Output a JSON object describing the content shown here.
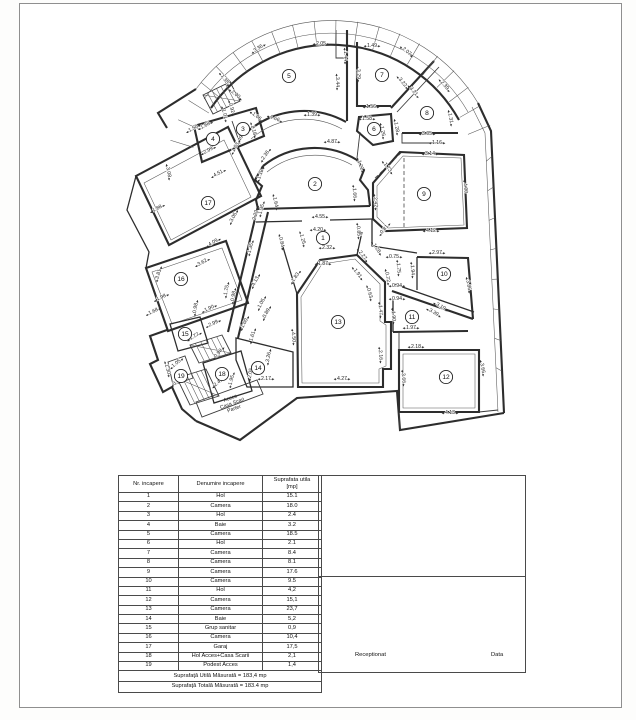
{
  "plan": {
    "rooms": [
      [
        "1",
        323,
        238
      ],
      [
        "2",
        315,
        184
      ],
      [
        "3",
        243,
        129
      ],
      [
        "4",
        213,
        139
      ],
      [
        "5",
        289,
        76
      ],
      [
        "6",
        374,
        129
      ],
      [
        "7",
        382,
        75
      ],
      [
        "8",
        427,
        113
      ],
      [
        "9",
        424,
        194
      ],
      [
        "10",
        444,
        274
      ],
      [
        "11",
        412,
        317
      ],
      [
        "12",
        446,
        377
      ],
      [
        "13",
        338,
        322
      ],
      [
        "14",
        258,
        368
      ],
      [
        "15",
        185,
        334
      ],
      [
        "16",
        181,
        279
      ],
      [
        "17",
        208,
        203
      ],
      [
        "18",
        222,
        374
      ],
      [
        "19",
        181,
        376
      ]
    ],
    "dims": [
      [
        "3.36",
        258,
        48,
        -33
      ],
      [
        "2.05",
        321,
        43,
        0
      ],
      [
        "1.49",
        372,
        45,
        0
      ],
      [
        "2.07",
        407,
        51,
        40
      ],
      [
        "1.44",
        346,
        56,
        88
      ],
      [
        "3.44",
        338,
        82,
        88
      ],
      [
        "3.29",
        359,
        74,
        88
      ],
      [
        "1.35",
        225,
        79,
        55
      ],
      [
        "2.00",
        236,
        94,
        40
      ],
      [
        "1.39",
        312,
        114,
        0
      ],
      [
        "1.66",
        275,
        118,
        22
      ],
      [
        "1.06",
        257,
        116,
        38
      ],
      [
        "0.92",
        232,
        108,
        75
      ],
      [
        "1.01",
        225,
        114,
        75
      ],
      [
        "3.22",
        403,
        82,
        50
      ],
      [
        "3.21",
        414,
        91,
        50
      ],
      [
        "2.39",
        445,
        85,
        50
      ],
      [
        "1.31",
        451,
        118,
        80
      ],
      [
        "1.56",
        371,
        106,
        0
      ],
      [
        "1.58",
        367,
        118,
        0
      ],
      [
        "1.26",
        383,
        131,
        80
      ],
      [
        "1.28",
        397,
        127,
        80
      ],
      [
        "3.05",
        427,
        133,
        0
      ],
      [
        "1.16",
        437,
        142,
        0
      ],
      [
        "4.87",
        332,
        141,
        0
      ],
      [
        "2.36",
        265,
        155,
        -55
      ],
      [
        "1.18",
        260,
        174,
        -70
      ],
      [
        "1.18",
        254,
        130,
        75
      ],
      [
        "1.21",
        361,
        165,
        70
      ],
      [
        "1.64",
        276,
        202,
        78
      ],
      [
        "1.66",
        355,
        193,
        85
      ],
      [
        "4.55",
        320,
        216,
        0
      ],
      [
        "4.20",
        318,
        229,
        0
      ],
      [
        "1.25",
        303,
        239,
        75
      ],
      [
        "0.84",
        282,
        242,
        78
      ],
      [
        "0.85",
        359,
        231,
        85
      ],
      [
        "2.32",
        327,
        247,
        0
      ],
      [
        "1.28",
        377,
        248,
        55
      ],
      [
        "1.73",
        388,
        167,
        52
      ],
      [
        "3.14",
        430,
        153,
        0
      ],
      [
        "4.00",
        466,
        188,
        85
      ],
      [
        "2.42",
        376,
        202,
        85
      ],
      [
        "4.12",
        431,
        230,
        0
      ],
      [
        "0.81",
        384,
        229,
        -50
      ],
      [
        "1.50",
        193,
        128,
        -28
      ],
      [
        "1.68",
        205,
        125,
        -28
      ],
      [
        "1.49",
        239,
        140,
        -60
      ],
      [
        "1.63",
        235,
        147,
        -60
      ],
      [
        "2.99",
        208,
        150,
        -28
      ],
      [
        "4.51",
        218,
        173,
        -28
      ],
      [
        "3.08",
        169,
        172,
        80
      ],
      [
        "1.88",
        157,
        208,
        -28
      ],
      [
        "3.05",
        233,
        217,
        -62
      ],
      [
        "2.22",
        255,
        215,
        -75
      ],
      [
        "1.35",
        261,
        209,
        -75
      ],
      [
        "4.09",
        213,
        242,
        -30
      ],
      [
        "1.35",
        250,
        248,
        -75
      ],
      [
        "3.62",
        202,
        262,
        -28
      ],
      [
        "3.81",
        158,
        274,
        -73
      ],
      [
        "1.75",
        226,
        290,
        -80
      ],
      [
        "0.98",
        233,
        296,
        -80
      ],
      [
        "1.98",
        161,
        297,
        -25
      ],
      [
        "1.68",
        153,
        311,
        -25
      ],
      [
        "1.90",
        209,
        308,
        -25
      ],
      [
        "0.98",
        195,
        308,
        -80
      ],
      [
        "2.99",
        213,
        323,
        -25
      ],
      [
        "4.13",
        255,
        281,
        -62
      ],
      [
        "1.05",
        261,
        303,
        -62
      ],
      [
        "0.89",
        266,
        313,
        -62
      ],
      [
        "1.60",
        244,
        323,
        -62
      ],
      [
        "1.61",
        252,
        336,
        -72
      ],
      [
        "1.77",
        194,
        336,
        -30
      ],
      [
        "0.98",
        218,
        353,
        -50
      ],
      [
        "3.26",
        268,
        357,
        -80
      ],
      [
        "2.05",
        250,
        373,
        -80
      ],
      [
        "2.17",
        266,
        378,
        0
      ],
      [
        "2.41",
        218,
        382,
        -40
      ],
      [
        "1.95",
        231,
        380,
        -75
      ],
      [
        "1.05",
        176,
        363,
        -40
      ],
      [
        "0.80",
        177,
        381,
        -40
      ],
      [
        "1.30",
        168,
        369,
        75
      ],
      [
        "1.87",
        323,
        263,
        0
      ],
      [
        "2.27",
        363,
        255,
        52
      ],
      [
        "1.91",
        358,
        273,
        52
      ],
      [
        "1.83",
        295,
        277,
        -55
      ],
      [
        "4.50",
        294,
        337,
        85
      ],
      [
        "4.27",
        342,
        378,
        0
      ],
      [
        "0.63",
        370,
        293,
        75
      ],
      [
        "1.47",
        381,
        310,
        85
      ],
      [
        "2.16",
        381,
        355,
        85
      ],
      [
        "0.75",
        394,
        256,
        0
      ],
      [
        "1.75",
        399,
        268,
        85
      ],
      [
        "0.72",
        388,
        277,
        80
      ],
      [
        "0.94",
        397,
        285,
        0
      ],
      [
        "1.94",
        413,
        270,
        85
      ],
      [
        "2.97",
        437,
        252,
        0
      ],
      [
        "3.86",
        469,
        285,
        80
      ],
      [
        "0.94",
        397,
        298,
        0
      ],
      [
        "1.90",
        394,
        316,
        85
      ],
      [
        "3.19",
        441,
        306,
        30
      ],
      [
        "3.39",
        434,
        312,
        30
      ],
      [
        "1.97",
        411,
        327,
        0
      ],
      [
        "2.18",
        416,
        346,
        0
      ],
      [
        "3.66",
        404,
        378,
        85
      ],
      [
        "3.66",
        483,
        368,
        80
      ],
      [
        "4.13",
        450,
        412,
        0
      ]
    ],
    "access_label": {
      "lines": [
        "Acces",
        "Casa Scari",
        "Parter"
      ],
      "x": 228,
      "y": 392,
      "r": -20
    }
  },
  "table": {
    "header_col1": "Nr. incapere",
    "header_col2": "Denumire incapere",
    "header_col3_line1": "Suprafata utila",
    "header_col3_line2": "[mp]",
    "rows": [
      [
        "1",
        "Hol",
        "15.1"
      ],
      [
        "2",
        "Camera",
        "18.0"
      ],
      [
        "3",
        "Hol",
        "2.4"
      ],
      [
        "4",
        "Baie",
        "3.2"
      ],
      [
        "5",
        "Camera",
        "18.5"
      ],
      [
        "6",
        "Hol",
        "2.1"
      ],
      [
        "7",
        "Camera",
        "8.4"
      ],
      [
        "8",
        "Camera",
        "8.1"
      ],
      [
        "9",
        "Camera",
        "17.6"
      ],
      [
        "10",
        "Camera",
        "9.5"
      ],
      [
        "11",
        "Hol",
        "4,2"
      ],
      [
        "12",
        "Camera",
        "15,1"
      ],
      [
        "13",
        "Camera",
        "23,7"
      ],
      [
        "14",
        "Baie",
        "5,2"
      ],
      [
        "15",
        "Grup sanitar",
        "0,9"
      ],
      [
        "16",
        "Camera",
        "10,4"
      ],
      [
        "17",
        "Garaj",
        "17,5"
      ],
      [
        "18",
        "Hol Acces+Casa Scarii",
        "2,1"
      ],
      [
        "19",
        "Podest Acces",
        "1,4"
      ]
    ],
    "footer1": "Suprafaţă Utilă Măsurată = 183,4 mp",
    "footer2": "Suprafaţă Totală Măsurată = 183.4 mp"
  },
  "signoff": {
    "receptionat": "Receptionat",
    "data": "Data"
  }
}
